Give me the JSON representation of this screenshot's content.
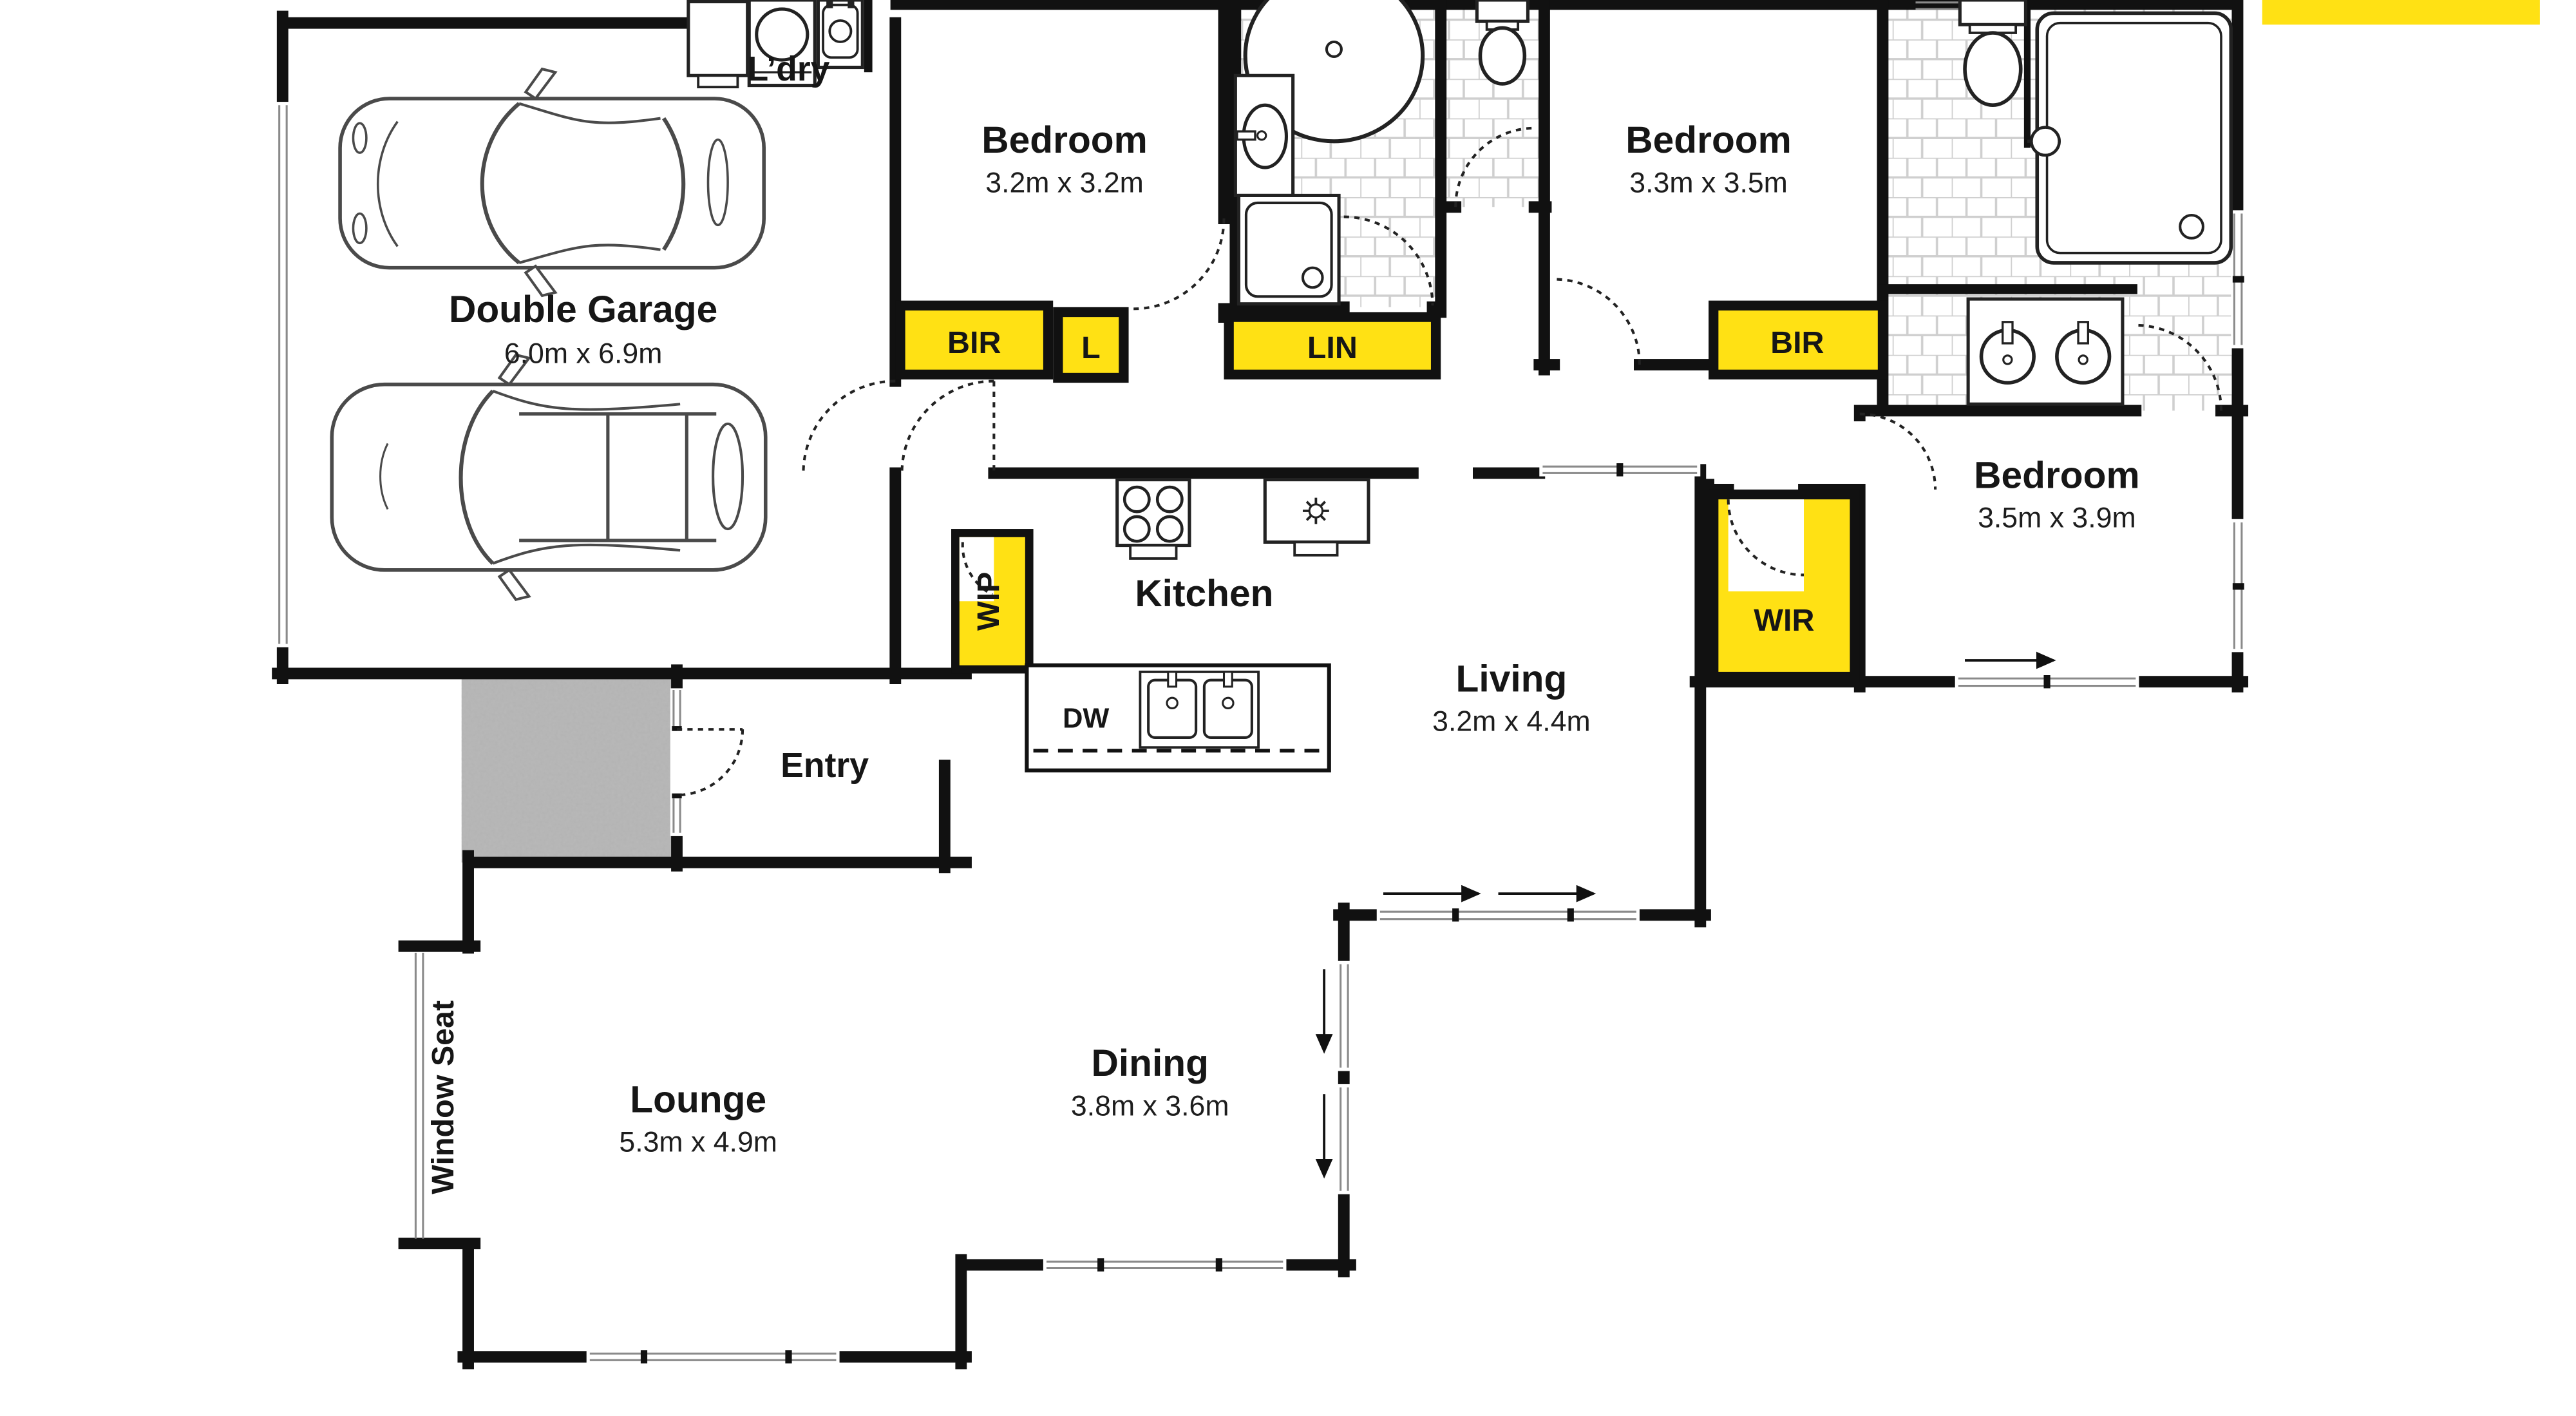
{
  "colors": {
    "closet_yellow": "#FFE114",
    "wall_black": "#111111",
    "tile_line": "#cccccc",
    "porch_gray": "#b9b9b9",
    "brand_bar_yellow": "#FFE114"
  },
  "rooms": {
    "garage": {
      "name": "Double Garage",
      "dims": "6.0m x 6.9m"
    },
    "laundry": {
      "name": "L’dry"
    },
    "bedroom1": {
      "name": "Bedroom",
      "dims": "3.2m x 3.2m"
    },
    "bedroom2": {
      "name": "Bedroom",
      "dims": "3.3m x 3.5m"
    },
    "bedroom3": {
      "name": "Bedroom",
      "dims": "3.5m x 3.9m"
    },
    "kitchen": {
      "name": "Kitchen"
    },
    "living": {
      "name": "Living",
      "dims": "3.2m x 4.4m"
    },
    "dining": {
      "name": "Dining",
      "dims": "3.8m x 3.6m"
    },
    "lounge": {
      "name": "Lounge",
      "dims": "5.3m x 4.9m"
    },
    "entry": {
      "name": "Entry"
    }
  },
  "storage": {
    "bir1": "BIR",
    "linen_small": "L",
    "lin": "LIN",
    "bir2": "BIR",
    "wir": "WIR",
    "wip": "WIP"
  },
  "features": {
    "dishwasher": "DW",
    "window_seat": "Window Seat"
  }
}
